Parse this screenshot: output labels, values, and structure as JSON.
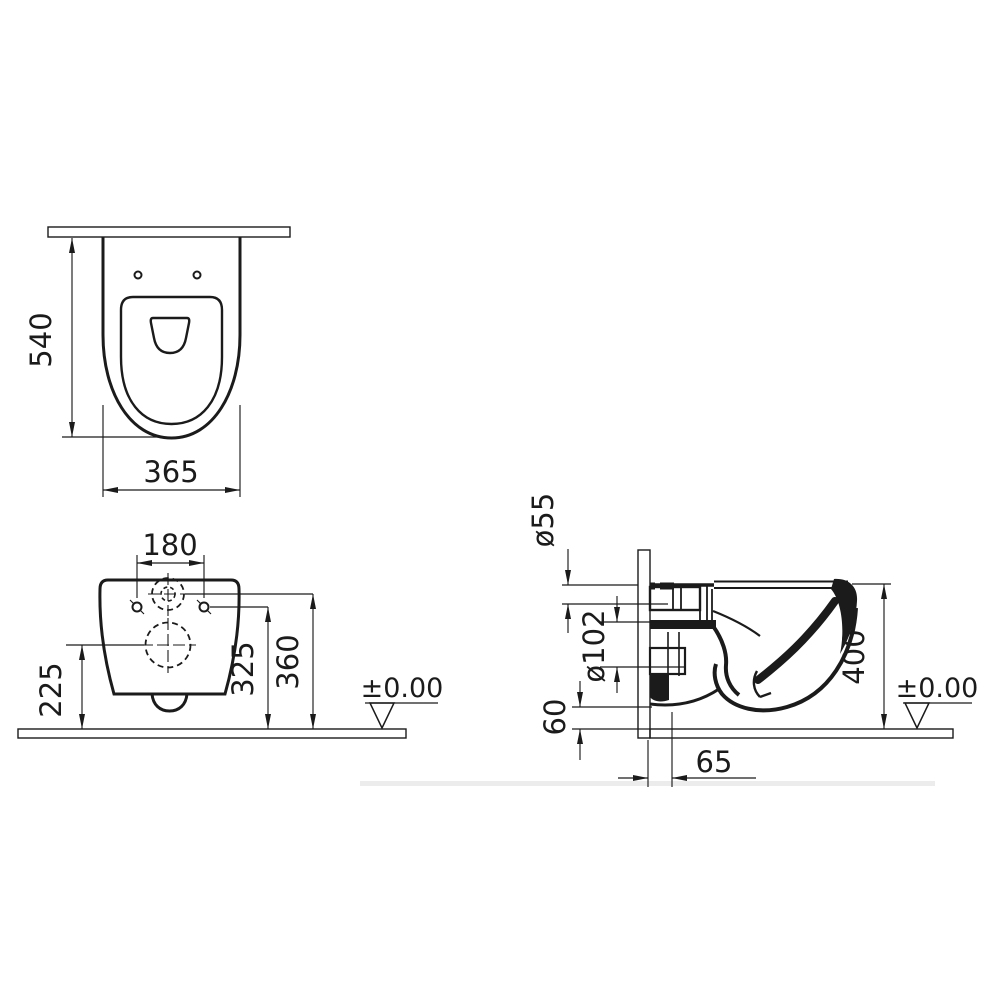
{
  "drawing": {
    "type": "wall-hung-toilet-technical-drawing",
    "top_view": {
      "depth": "540",
      "width": "365"
    },
    "front_view": {
      "hole_spacing": "180",
      "drain_height": "225",
      "hole_height": "325",
      "inlet_height": "360",
      "floor_level": "±0.00"
    },
    "side_view": {
      "inlet_diameter": "ø55",
      "drain_diameter": "ø102",
      "overall_height": "400",
      "outlet_bottom_offset": "60",
      "outlet_wall_offset": "65",
      "floor_level": "±0.00"
    },
    "colors": {
      "line": "#1b1b1b",
      "background": "#ffffff",
      "hatch": "#3a3a3a"
    }
  }
}
